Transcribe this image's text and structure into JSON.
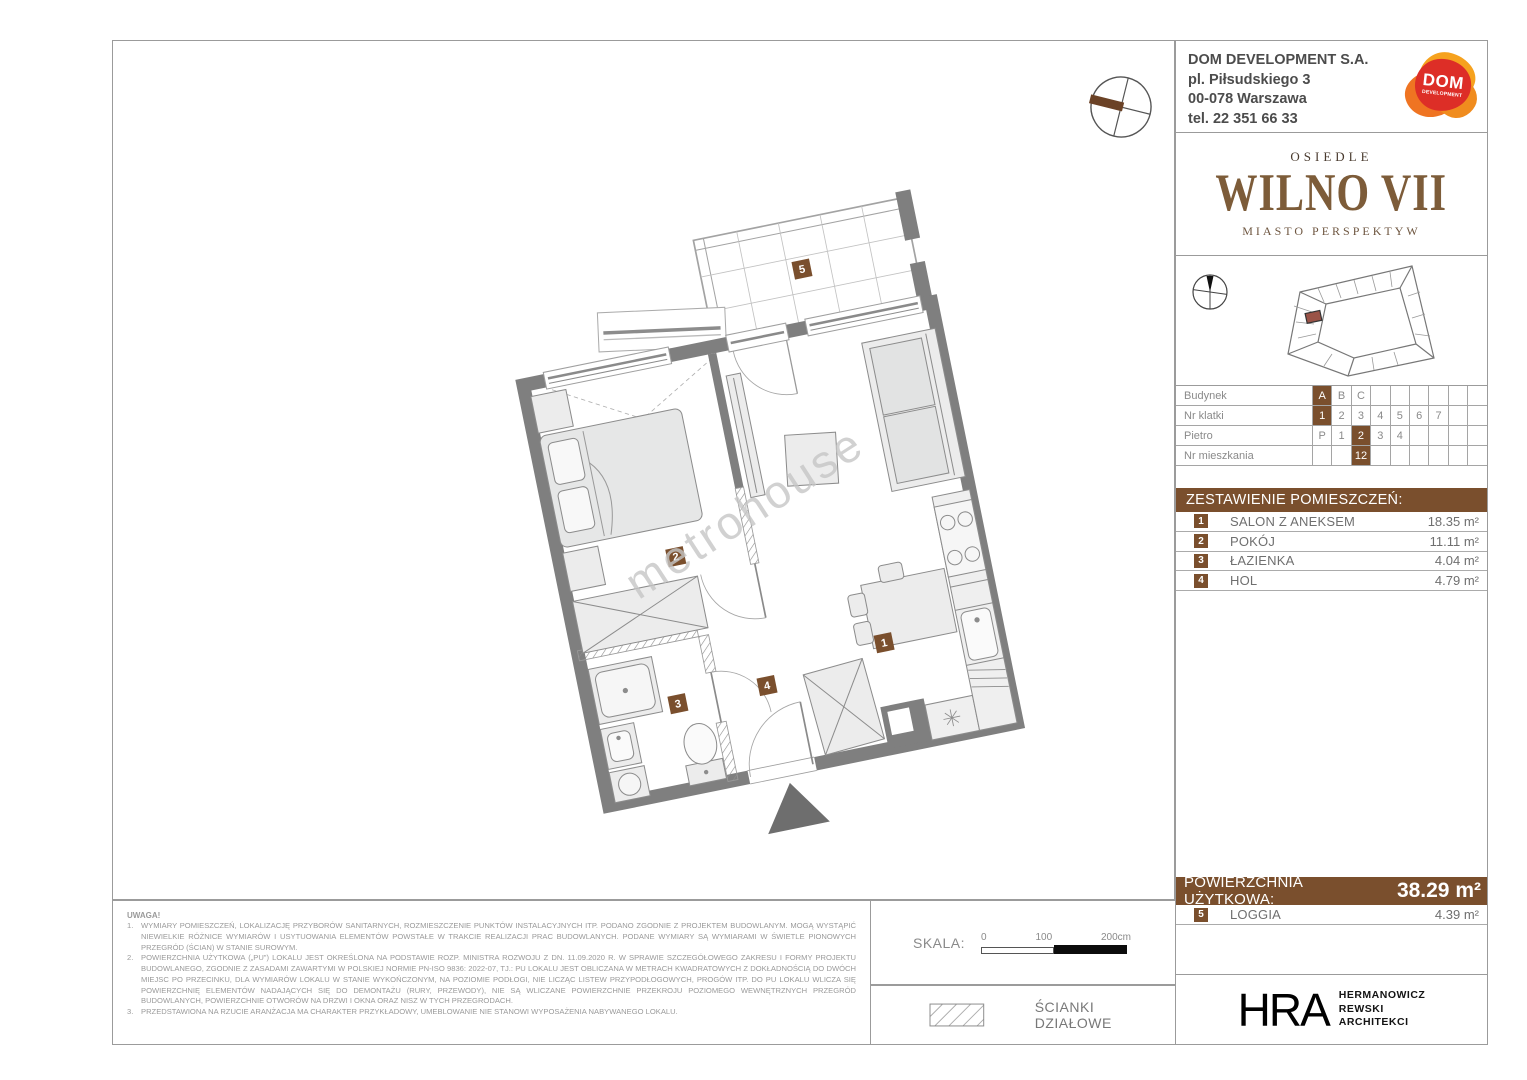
{
  "developer": {
    "name": "DOM DEVELOPMENT S.A.",
    "address_line1": "pl. Piłsudskiego 3",
    "address_line2": "00-078 Warszawa",
    "phone": "tel. 22 351 66 33",
    "logo_text": "DOM",
    "logo_subtext": "DEVELOPMENT"
  },
  "brand": {
    "estate_label": "OSIEDLE",
    "estate_name": "WILNO VII",
    "tagline": "MIASTO PERSPEKTYW"
  },
  "location_table": {
    "rows": [
      {
        "label": "Budynek",
        "cells": [
          "A",
          "B",
          "C",
          "",
          "",
          "",
          "",
          "",
          ""
        ],
        "selected": 0
      },
      {
        "label": "Nr klatki",
        "cells": [
          "1",
          "2",
          "3",
          "4",
          "5",
          "6",
          "7",
          "",
          ""
        ],
        "selected": 0
      },
      {
        "label": "Pietro",
        "cells": [
          "P",
          "1",
          "2",
          "3",
          "4",
          "",
          "",
          "",
          ""
        ],
        "selected": 2
      },
      {
        "label": "Nr mieszkania",
        "cells": [
          "",
          "",
          "12",
          "",
          "",
          "",
          "",
          "",
          ""
        ],
        "selected": 2
      }
    ]
  },
  "rooms": {
    "header": "ZESTAWIENIE POMIESZCZEŃ:",
    "items": [
      {
        "no": "1",
        "name": "SALON Z ANEKSEM",
        "area": "18.35 m²"
      },
      {
        "no": "2",
        "name": "POKÓJ",
        "area": "11.11 m²"
      },
      {
        "no": "3",
        "name": "ŁAZIENKA",
        "area": "4.04 m²"
      },
      {
        "no": "4",
        "name": "HOL",
        "area": "4.79 m²"
      }
    ]
  },
  "summary": {
    "label": "POWIERZCHNIA UŻYTKOWA:",
    "value": "38.29 m²",
    "extra": {
      "no": "5",
      "name": "LOGGIA",
      "area": "4.39 m²"
    }
  },
  "notes": {
    "title": "UWAGA!",
    "items": [
      {
        "no": "1.",
        "text": "WYMIARY POMIESZCZEŃ, LOKALIZACJĘ PRZYBORÓW SANITARNYCH, ROZMIESZCZENIE PUNKTÓW INSTALACYJNYCH ITP. PODANO ZGODNIE Z PROJEKTEM BUDOWLANYM. MOGĄ WYSTĄPIĆ NIEWIELKIE RÓŻNICE WYMIARÓW I USYTUOWANIA ELEMENTÓW POWSTAŁE W TRAKCIE REALIZACJI PRAC BUDOWLANYCH. PODANE WYMIARY SĄ WYMIARAMI W ŚWIETLE PIONOWYCH PRZEGRÓD (ŚCIAN) W STANIE SUROWYM."
      },
      {
        "no": "2.",
        "text": "POWIERZCHNIA UŻYTKOWA („PU\") LOKALU JEST OKREŚLONA NA PODSTAWIE ROZP. MINISTRA ROZWOJU Z DN. 11.09.2020 R. W SPRAWIE SZCZEGÓŁOWEGO ZAKRESU I FORMY PROJEKTU BUDOWLANEGO, ZGODNIE Z ZASADAMI ZAWARTYMI W POLSKIEJ NORMIE PN-ISO 9836: 2022-07, TJ.: PU LOKALU JEST OBLICZANA W METRACH KWADRATOWYCH Z DOKŁADNOŚCIĄ DO DWÓCH MIEJSC PO PRZECINKU, DLA WYMIARÓW LOKALU W STANIE WYKOŃCZONYM, NA POZIOMIE PODŁOGI, NIE LICZĄC LISTEW PRZYPODŁOGOWYCH, PROGÓW ITP. DO PU LOKALU WLICZA SIĘ POWIERZCHNIĘ ELEMENTÓW NADAJĄCYCH SIĘ DO DEMONTAŻU (RURY, PRZEWODY), NIE SĄ WLICZANE POWIERZCHNIE PRZEKROJU POZIOMEGO WEWNĘTRZNYCH PRZEGRÓD BUDOWLANYCH, POWIERZCHNIE OTWORÓW NA DRZWI I OKNA ORAZ NISZ W TYCH PRZEGRODACH."
      },
      {
        "no": "3.",
        "text": "PRZEDSTAWIONA NA RZUCIE ARANŻACJA MA CHARAKTER PRZYKŁADOWY, UMEBLOWANIE NIE STANOWI WYPOSAŻENIA NABYWANEGO LOKALU."
      }
    ]
  },
  "scale": {
    "label": "SKALA:",
    "ticks": [
      "0",
      "100",
      "200cm"
    ]
  },
  "legend": {
    "partition_label": "ŚCIANKI DZIAŁOWE"
  },
  "architect": {
    "abbr": "HRA",
    "lines": [
      "HERMANOWICZ",
      "REWSKI",
      "ARCHITEKCI"
    ]
  },
  "watermark": "metrohouse",
  "plan": {
    "badges": [
      "1",
      "2",
      "3",
      "4",
      "5"
    ]
  },
  "colors": {
    "accent_brown": "#7a4f2d",
    "logo_brown": "#7d5c39",
    "wall_gray": "#7f7f7f",
    "furniture_fill": "#ececec",
    "highlight_unit_red": "#9a5347",
    "dom_orange": "#f6a21e",
    "dom_red": "#dd2e27"
  }
}
